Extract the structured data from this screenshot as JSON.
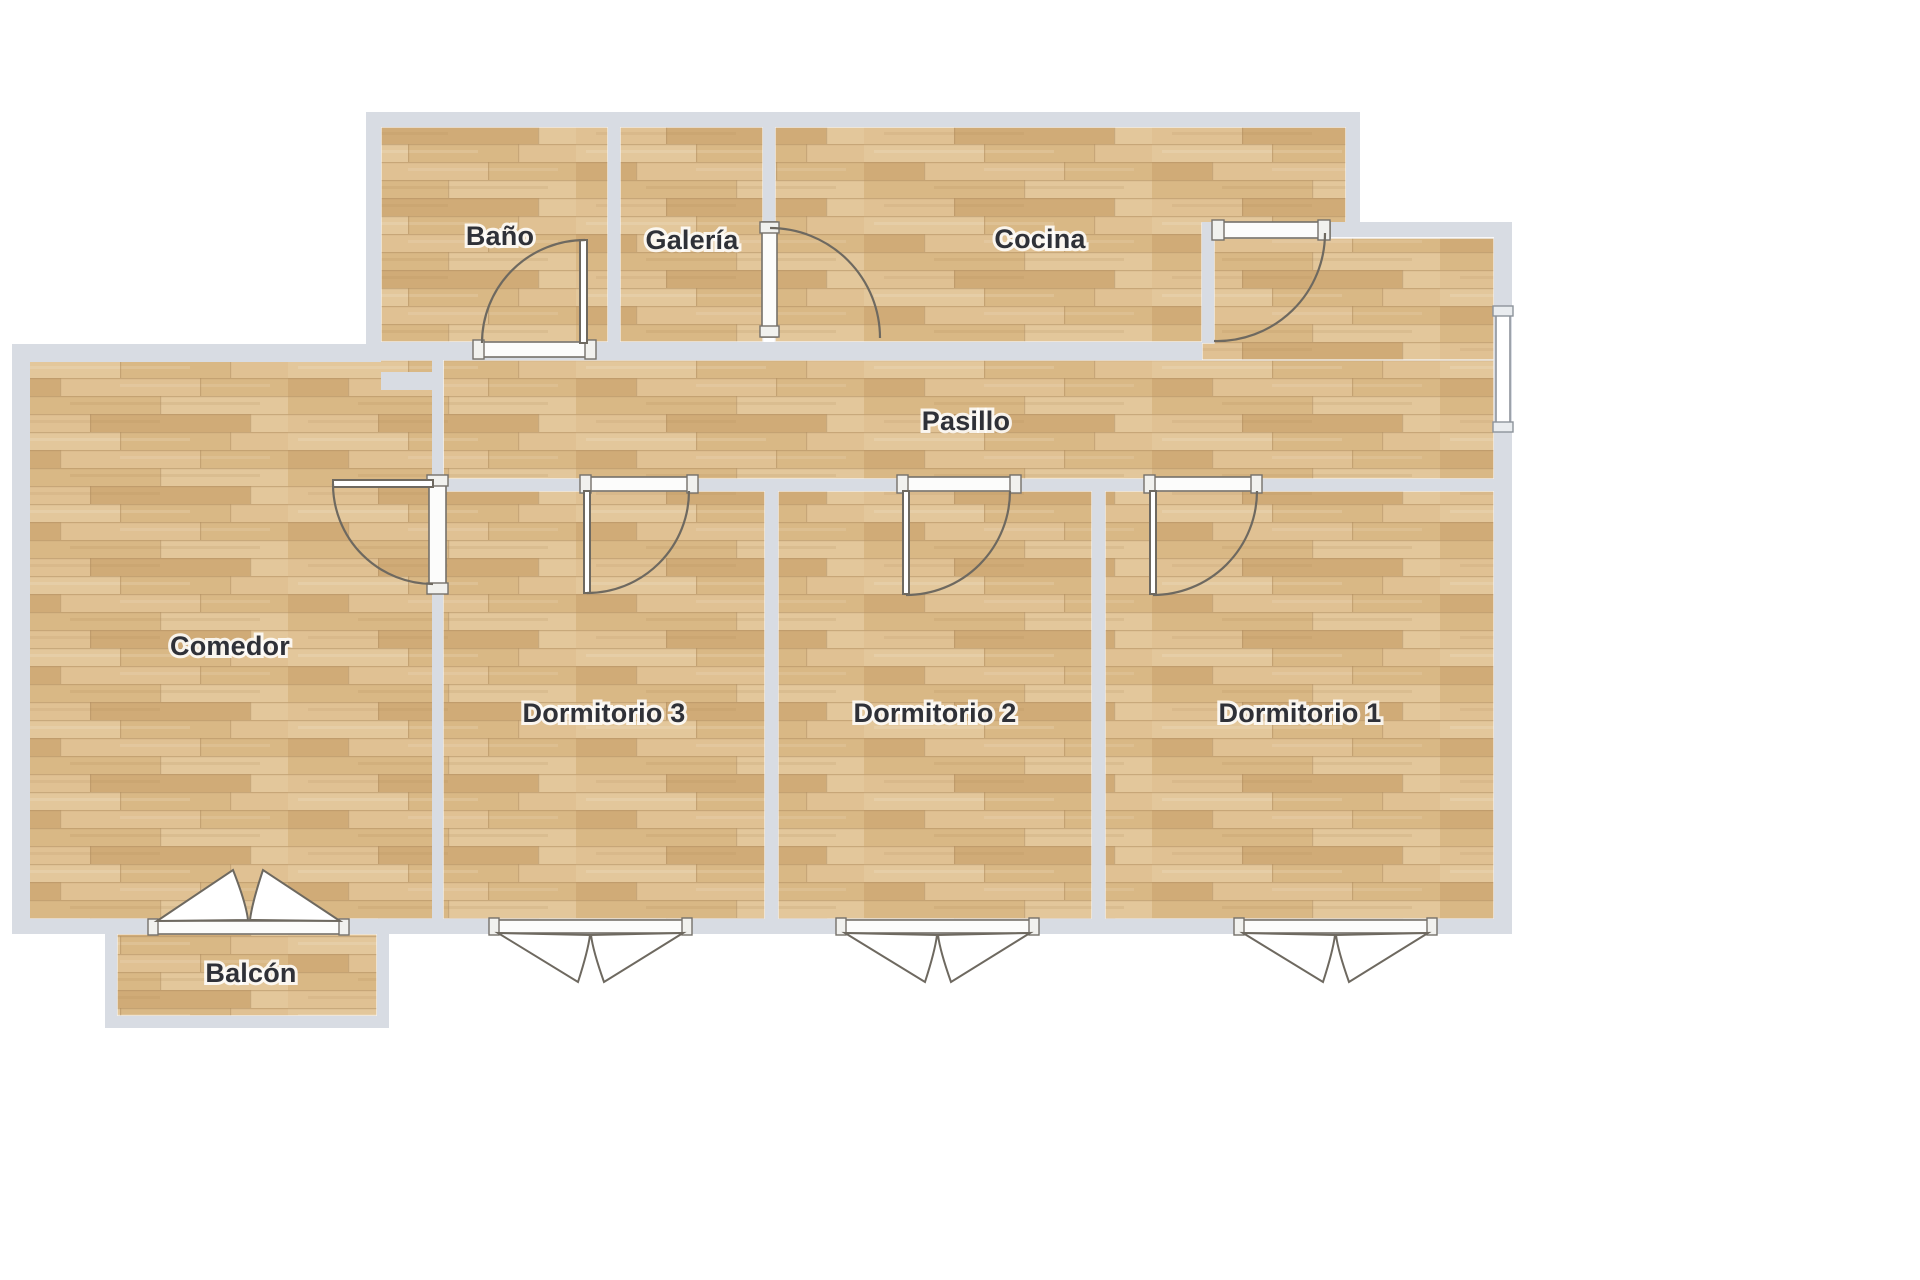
{
  "floorplan": {
    "type": "apartment-floor-plan",
    "language": "es",
    "rooms": [
      {
        "id": "bano",
        "label": "Baño"
      },
      {
        "id": "galeria",
        "label": "Galería"
      },
      {
        "id": "cocina",
        "label": "Cocina"
      },
      {
        "id": "pasillo",
        "label": "Pasillo"
      },
      {
        "id": "comedor",
        "label": "Comedor"
      },
      {
        "id": "dormitorio3",
        "label": "Dormitorio 3"
      },
      {
        "id": "dormitorio2",
        "label": "Dormitorio 2"
      },
      {
        "id": "dormitorio1",
        "label": "Dormitorio 1"
      },
      {
        "id": "balcon",
        "label": "Balcón"
      }
    ],
    "colors": {
      "background": "#ffffff",
      "wall": "#d8dce3",
      "floor_base": "#dabb8c",
      "floor_seam": "#b29062",
      "door_line": "#6e6960",
      "label_text": "#2f3138"
    }
  }
}
